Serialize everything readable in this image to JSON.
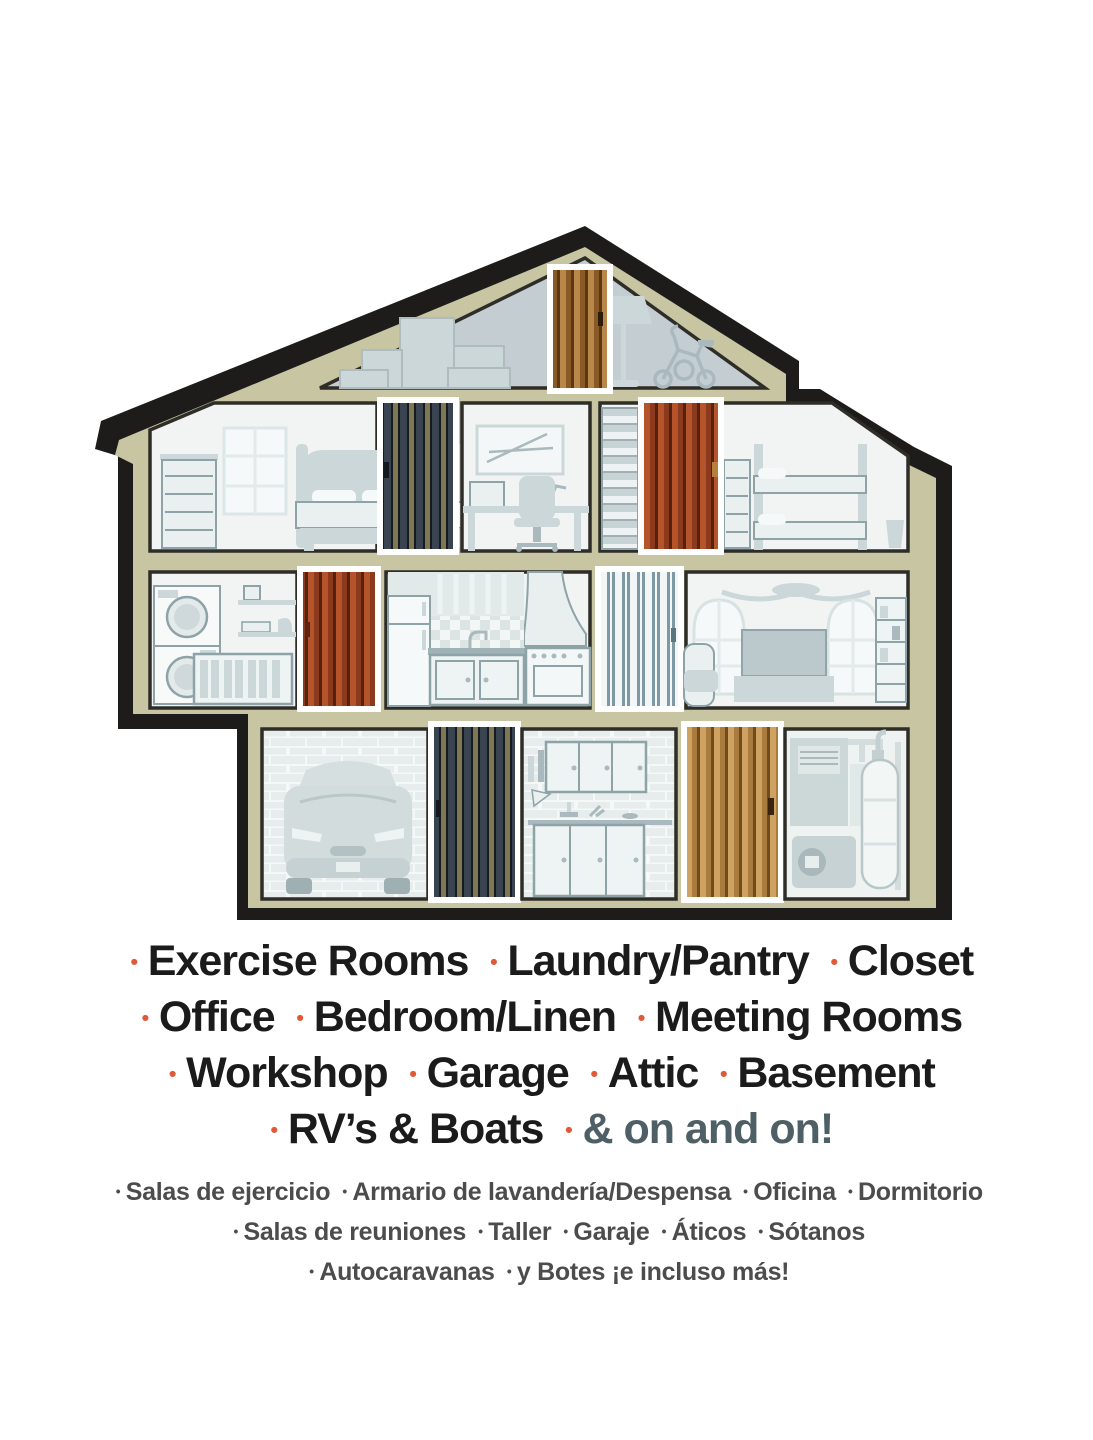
{
  "bullet": "•",
  "colors": {
    "outline": "#1d1c1a",
    "wall": "#c7c5a2",
    "attic": "#c4ced2",
    "room": "#f1f4f3",
    "room_shade": "#e7edec",
    "utility_room": "#eef2f1",
    "door_frame": "#ffffff",
    "door_brown_light": "#b8874a",
    "door_brown_dark": "#8a5a26",
    "door_brown_line": "#5a3813",
    "door_dark_navy": "#3a4450",
    "door_dark_olive": "#7f7752",
    "door_dark_line": "#161b22",
    "door_red_light": "#b5532b",
    "door_red_dark": "#8c3a1d",
    "door_red_line": "#54220f",
    "door_gray_bg": "#f3f6f6",
    "door_gray_stripe": "#7f99a4",
    "door_tan_light": "#cfa261",
    "door_tan_dark": "#a97b3c",
    "door_tan_line": "#6f4c1e",
    "bullet_orange": "#e2593a",
    "accent_slate": "#4e5f66",
    "text_black": "#1b1b1b",
    "text_gray": "#4c4c4c"
  },
  "en": {
    "line1": [
      "Exercise Rooms",
      "Laundry/Pantry",
      "Closet"
    ],
    "line2": [
      "Office",
      "Bedroom/Linen",
      "Meeting Rooms"
    ],
    "line3": [
      "Workshop",
      "Garage",
      "Attic",
      "Basement"
    ],
    "line4": [
      "RV’s & Boats"
    ],
    "line4_accent": "& on and on!"
  },
  "es": {
    "line1": [
      "Salas de ejercicio",
      "Armario de lavandería/Despensa",
      "Oficina",
      "Dormitorio"
    ],
    "line2": [
      "Salas de reuniones",
      "Taller",
      "Garaje",
      "Áticos",
      "Sótanos"
    ],
    "line3": [
      "Autocaravanas",
      "y Botes ¡e incluso más!"
    ]
  }
}
